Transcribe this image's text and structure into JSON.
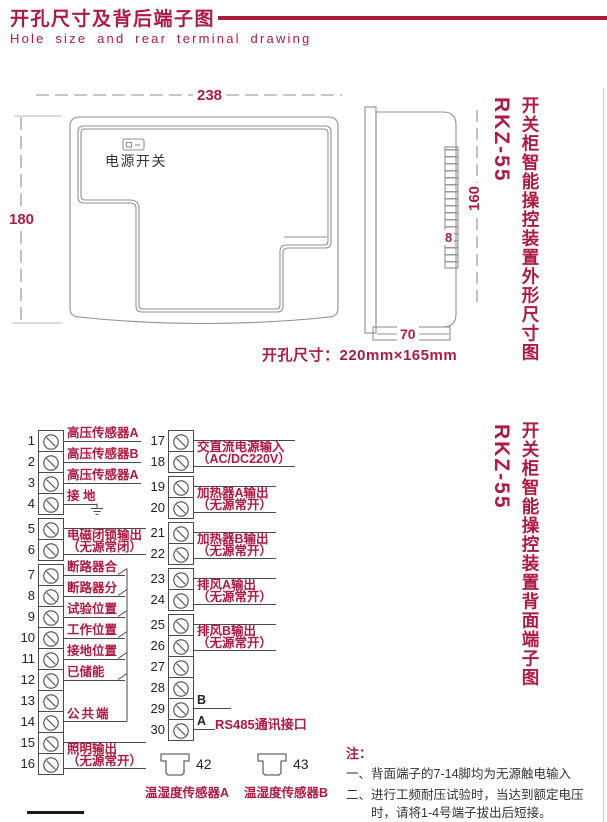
{
  "header": {
    "title": "开孔尺寸及背后端子图",
    "subtitle": "Hole size and rear terminal drawing"
  },
  "colors": {
    "accent": "#ab1b42",
    "ink": "#333333",
    "drawing_line": "#909090"
  },
  "outline": {
    "front_width": "238",
    "front_height": "180",
    "power_switch": "电源开关",
    "hole_size": "开孔尺寸：220mm×165mm",
    "side_height": "160",
    "side_strip": "8",
    "side_depth": "70"
  },
  "section_titles": [
    {
      "model": "RKZ-55",
      "caption": "开关柜智能操控装置外形尺寸图"
    },
    {
      "model": "RKZ-55",
      "caption": "开关柜智能操控装置背面端子图"
    }
  ],
  "terminal_panel": {
    "left_numbers": [
      1,
      2,
      3,
      4,
      5,
      6,
      7,
      8,
      9,
      10,
      11,
      12,
      13,
      14,
      15,
      16
    ],
    "right_numbers": [
      17,
      18,
      19,
      20,
      21,
      22,
      23,
      24,
      25,
      26,
      27,
      28,
      29,
      30
    ],
    "left_labels": [
      {
        "from": 1,
        "to": 1,
        "text": "高压传感器A"
      },
      {
        "from": 2,
        "to": 2,
        "text": "高压传感器B"
      },
      {
        "from": 3,
        "to": 3,
        "text": "高压传感器A"
      },
      {
        "from": 4,
        "to": 4,
        "text": "接 地",
        "ground": true
      },
      {
        "from": 5,
        "to": 6,
        "text": "电磁闭锁输出",
        "sub": "（无源常闭）"
      },
      {
        "from": 7,
        "to": 7,
        "text": "断路器合",
        "switch": true
      },
      {
        "from": 8,
        "to": 8,
        "text": "断路器分",
        "switch": true
      },
      {
        "from": 9,
        "to": 9,
        "text": "试验位置",
        "switch": true
      },
      {
        "from": 10,
        "to": 10,
        "text": "工作位置",
        "switch": true
      },
      {
        "from": 11,
        "to": 11,
        "text": "接地位置",
        "switch": true
      },
      {
        "from": 12,
        "to": 12,
        "text": "已储能",
        "switch": true
      },
      {
        "from": 14,
        "to": 14,
        "text": "公共端",
        "common": true
      },
      {
        "from": 15,
        "to": 16,
        "text": "照明输出",
        "sub": "（无源常开）"
      }
    ],
    "right_labels": [
      {
        "from": 17,
        "to": 18,
        "text": "交直流电源输入",
        "sub": "（AC/DC220V）"
      },
      {
        "from": 19,
        "to": 20,
        "text": "加热器A输出",
        "sub": "（无源常开）"
      },
      {
        "from": 21,
        "to": 22,
        "text": "加热器B输出",
        "sub": "（无源常开）"
      },
      {
        "from": 23,
        "to": 24,
        "text": "排风A输出",
        "sub": "（无源常开）"
      },
      {
        "from": 25,
        "to": 26,
        "text": "排风B输出",
        "sub": "（无源常开）"
      },
      {
        "from": 29,
        "to": 29,
        "text": "B",
        "black": true
      },
      {
        "from": 30,
        "to": 30,
        "text": "A",
        "black": true,
        "suffix": "RS485通讯接口"
      }
    ],
    "sensor_plugs": [
      {
        "number": "42",
        "label": "温湿度传感器A"
      },
      {
        "number": "43",
        "label": "温湿度传感器B"
      }
    ]
  },
  "notes": {
    "heading": "注：",
    "items": [
      "一、背面端子的7-14脚均为无源触电输入",
      "二、进行工频耐压试验时，当达到额定电压时，请将1-4号端子拔出后短接。"
    ]
  }
}
